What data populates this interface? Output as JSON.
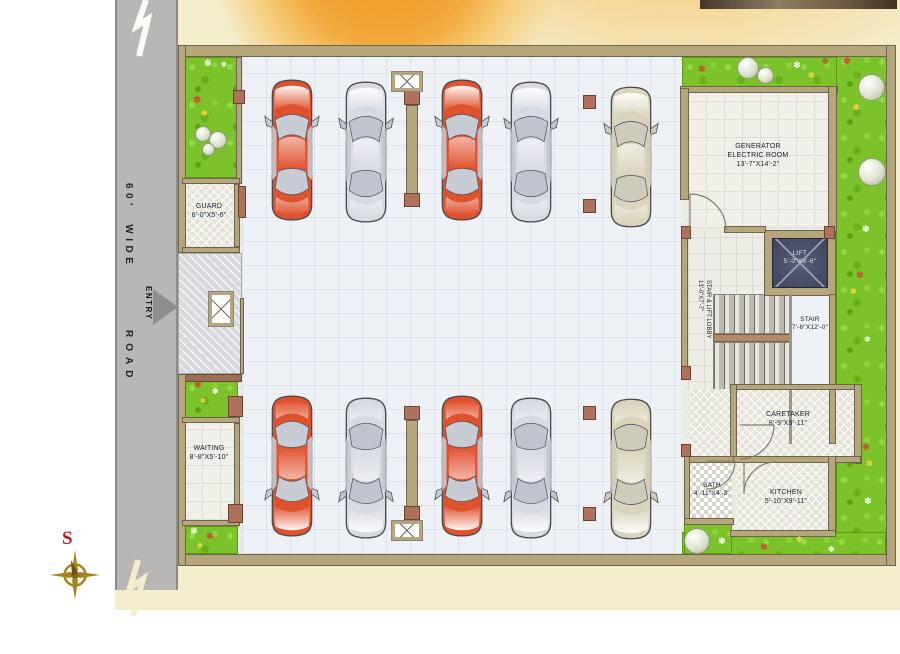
{
  "scene": {
    "road": {
      "label_top": "60' WIDE",
      "entry_label": "ENTRY",
      "label_bottom": "ROAD"
    },
    "compass": {
      "south_label": "S"
    },
    "rooms": {
      "guard": {
        "name": "GUARD",
        "dims": "6'-0\"X5'-6\""
      },
      "waiting": {
        "name": "WAITING",
        "dims": "8'-8\"X5'-10\""
      },
      "generator": {
        "name": "GENERATOR ELECTRIC ROOM",
        "dims": "13'-7\"X14'-2\""
      },
      "lift": {
        "name": "LIFT",
        "dims": "5'-0\"X6'-6\""
      },
      "stair": {
        "name": "STAIR",
        "dims": "7'-6\"X12'-0\""
      },
      "lobby": {
        "name": "STAIR & LIFT LOBBY",
        "dims": "13'-0\"X7'-7\""
      },
      "caretaker": {
        "name": "CARETAKER",
        "dims": "8'-9\"X9'-11\""
      },
      "bath": {
        "name": "BATH",
        "dims": "4'-11\"X4'-3\""
      },
      "kitchen": {
        "name": "KITCHEN",
        "dims": "5'-10\"X9'-11\""
      }
    },
    "cars": [
      "red",
      "silver",
      "red",
      "silver",
      "beige",
      "red",
      "silver",
      "red",
      "silver",
      "beige"
    ],
    "icons": {
      "flower": "✽"
    },
    "colors": {
      "cream": "#F4EDCC",
      "accent_orange": "#F0961E",
      "road": "#B9B6B6",
      "wall": "#B5A67C",
      "wall_dark": "#6C644E",
      "column": "#AF7159",
      "grass": "#7CC32B",
      "lift_cab": "#3E4458",
      "label_text": "#18222F",
      "compass_red": "#C41424",
      "compass_gold": "#A8821A",
      "car_palette": {
        "red": {
          "body": "#E0522E",
          "glass": "#C7CBD4"
        },
        "silver": {
          "body": "#D6DAE2",
          "glass": "#BFC4CE"
        },
        "beige": {
          "body": "#DAD4BC",
          "glass": "#CFCBBA"
        }
      }
    }
  }
}
